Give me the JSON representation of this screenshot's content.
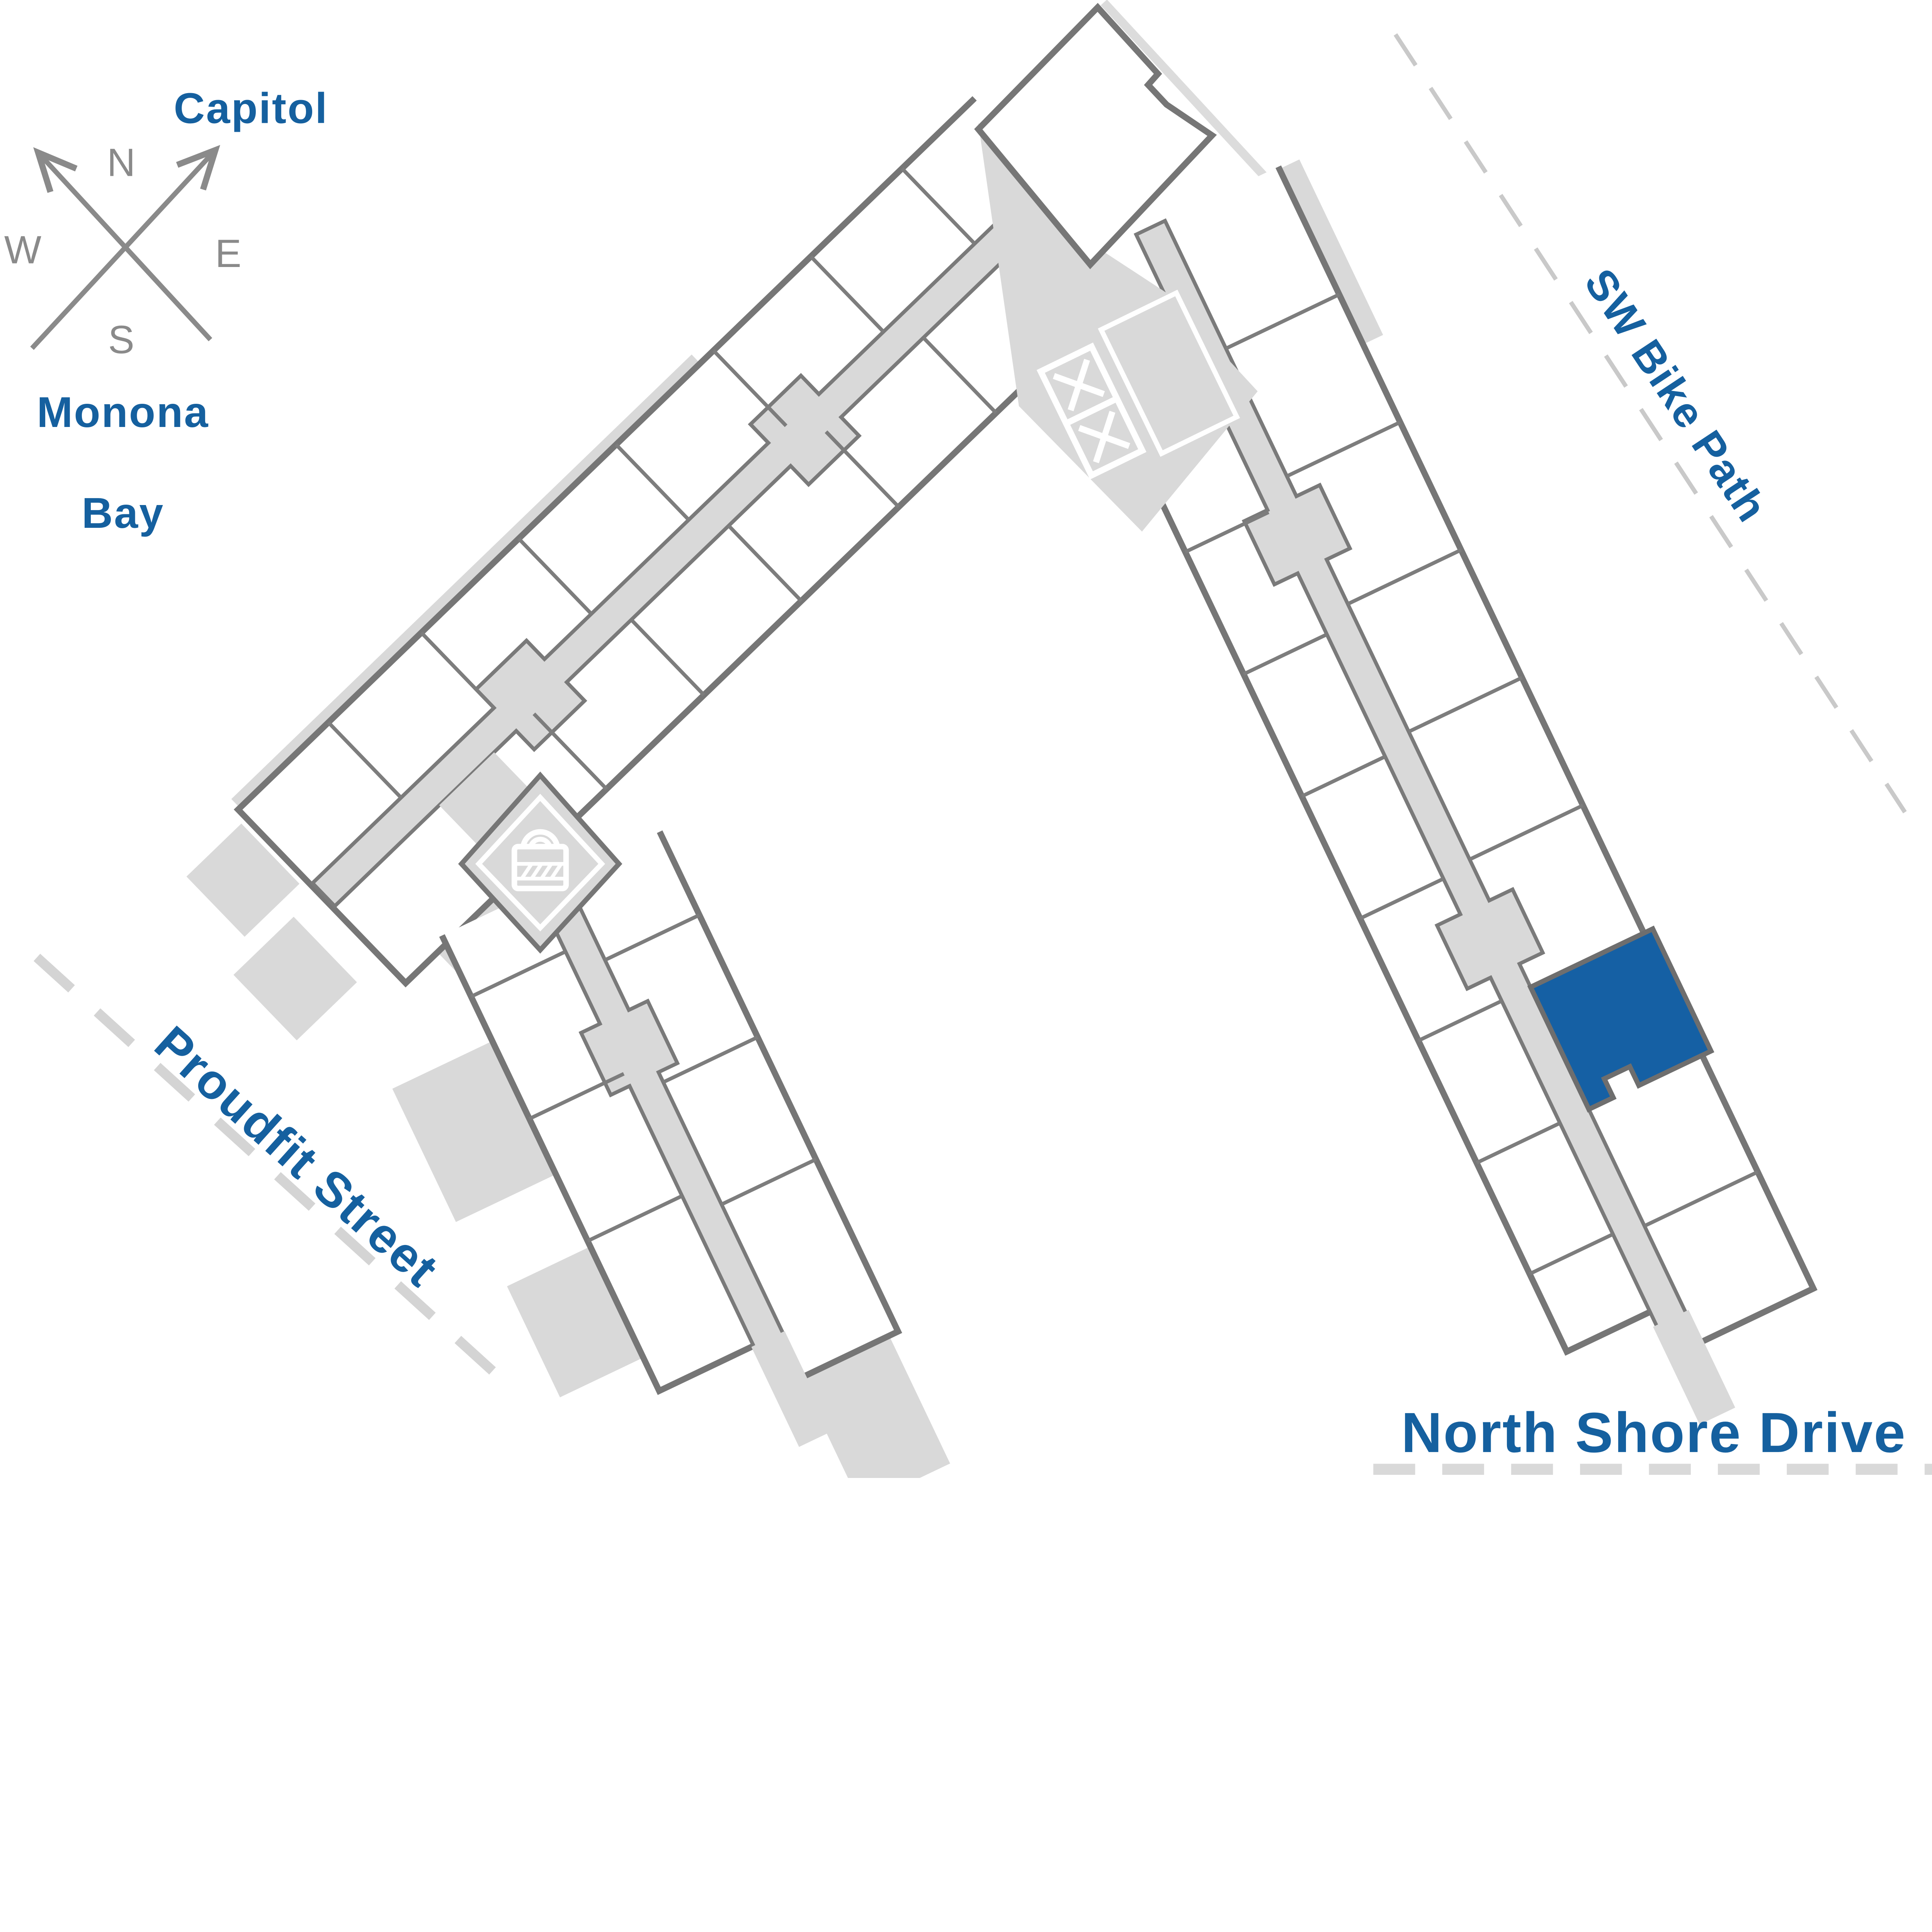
{
  "compass": {
    "n": "N",
    "e": "E",
    "s": "S",
    "w": "W"
  },
  "landmarks": {
    "capitol": "Capitol",
    "monona_line1": "Monona",
    "monona_line2": "Bay"
  },
  "streets": {
    "bike_path": "SW Bike Path",
    "proudfit": "Proudfit Street",
    "north_shore": "North Shore Drive"
  },
  "icons": {
    "compass": "compass-rose-icon",
    "lock": "padlock-icon",
    "elevators": "elevator-x-icon"
  },
  "selected_unit": {
    "label": "Selected unit"
  },
  "colors": {
    "accent_blue": "#1560a4",
    "text_blue": "#15609f",
    "outline_gray": "#767676",
    "divider_gray": "#7d7d7d",
    "fill_gray": "#d9d9d9",
    "compass_gray": "#8a8a8a",
    "dash_light": "#d4d4d4",
    "dash_bike": "#c9c9c9"
  }
}
